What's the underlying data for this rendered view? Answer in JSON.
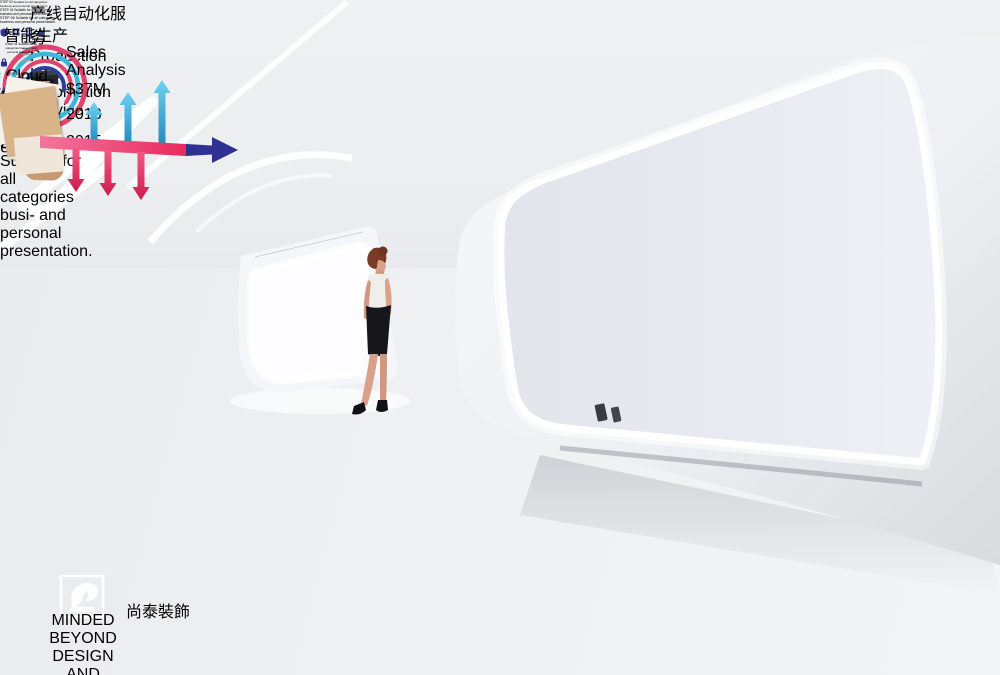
{
  "left_wall": {
    "title": "产线自动化服务",
    "subtitle": "Production Line Automation Service",
    "sales_heading": "Sales Analysis",
    "sales_value": "$37M",
    "years": [
      "2013",
      "2015"
    ]
  },
  "right_wall": {
    "title": "智能生产",
    "screen_label": "Cloud Search",
    "steps_top": [
      {
        "step": "STEP 02",
        "desc": "Suitable for all categories business and personal presentation"
      },
      {
        "step": "STEP 04",
        "desc": "Suitable for all categories business and personal presentation"
      },
      {
        "step": "STEP 06",
        "desc": "Suitable for all categories business and personal presentation"
      }
    ],
    "steps_bottom": [
      {
        "step": "STEP 01",
        "desc": "Suitable for all categories business and personal presentation"
      },
      {
        "step": "STEP 03",
        "desc": "Suitable for all categories business and personal presentation"
      },
      {
        "step": "STEP 05",
        "desc": "Suitable for all categories business and personal presentation"
      }
    ],
    "final_note": {
      "step": "STEP 06",
      "desc": "Suitable for all categories busi- and personal presentation."
    }
  },
  "watermark": {
    "brand": "MINDED BEYOND",
    "line2": "DESIGN",
    "line3": "AND DECORATION",
    "brand_cn": "尚泰裝飾"
  },
  "colors": {
    "accent_pink": "#ec2f63",
    "accent_cyan": "#3bb7dd",
    "accent_navy": "#2e3192",
    "accent_blue_text": "#2d57c4",
    "wood": "#d7ab63",
    "led_white": "#ffffff"
  }
}
